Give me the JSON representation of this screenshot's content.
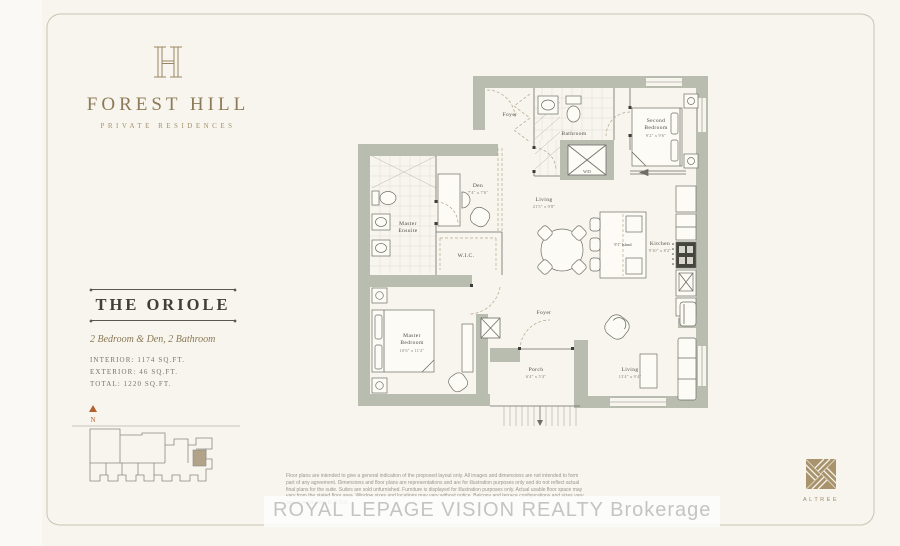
{
  "brand": {
    "name": "FOREST HILL",
    "tagline": "PRIVATE RESIDENCES"
  },
  "unit": {
    "name": "THE ORIOLE",
    "type": "2 Bedroom & Den, 2 Bathroom",
    "interior": "INTERIOR: 1174 SQ.FT.",
    "exterior": "EXTERIOR: 46 SQ.FT.",
    "total": "TOTAL: 1220 SQ.FT."
  },
  "keyplan": {
    "north": "N"
  },
  "rooms": {
    "foyer_upper": {
      "name": "Foyer"
    },
    "bathroom": {
      "name": "Bathroom"
    },
    "second_bedroom": {
      "l1": "Second",
      "l2": "Bedroom",
      "dims": "9'2\" x 9'6\""
    },
    "laundry": {
      "name": "W/D"
    },
    "den": {
      "name": "Den",
      "dims": "7'4\" x 7'6\""
    },
    "living": {
      "name": "Living",
      "dims": "21'5\" x 9'8\""
    },
    "kitchen": {
      "name": "Kitchen",
      "dims": "9'10\" x 8'2\""
    },
    "island": {
      "name": "9'1\" Island"
    },
    "ensuite": {
      "l1": "Master",
      "l2": "Ensuite"
    },
    "wic": {
      "name": "W.I.C."
    },
    "master_bedroom": {
      "l1": "Master",
      "l2": "Bedroom",
      "dims": "10'6\" x 11'2\""
    },
    "foyer_lower": {
      "name": "Foyer"
    },
    "porch": {
      "name": "Porch",
      "dims": "6'4\" x 5'4\""
    },
    "living2": {
      "name": "Living",
      "dims": "13'4\" x 9'4\""
    }
  },
  "footer": {
    "disclaimer": "Floor plans are intended to give a general indication of the proposed layout only. All images and dimensions are not intended to form part of any agreement. Dimensions and floor plans are representations and are for illustration purposes only and do not reflect actual final plans for the suite. Suites are sold unfurnished. Furniture is displayed for illustration purposes only. Actual usable floor space may vary from the stated floor area. Window sizes and locations may vary without notice. Balcony and terrace configurations and sizes vary based on location. E. & O.E.",
    "watermark": "ROYAL LEPAGE VISION REALTY Brokerage",
    "developer": "ALTREE"
  },
  "colors": {
    "brand": "#8d7a58",
    "wall": "#b9bdb0",
    "north_arrow": "#b2602f",
    "unit_highlight": "#b2a287"
  }
}
